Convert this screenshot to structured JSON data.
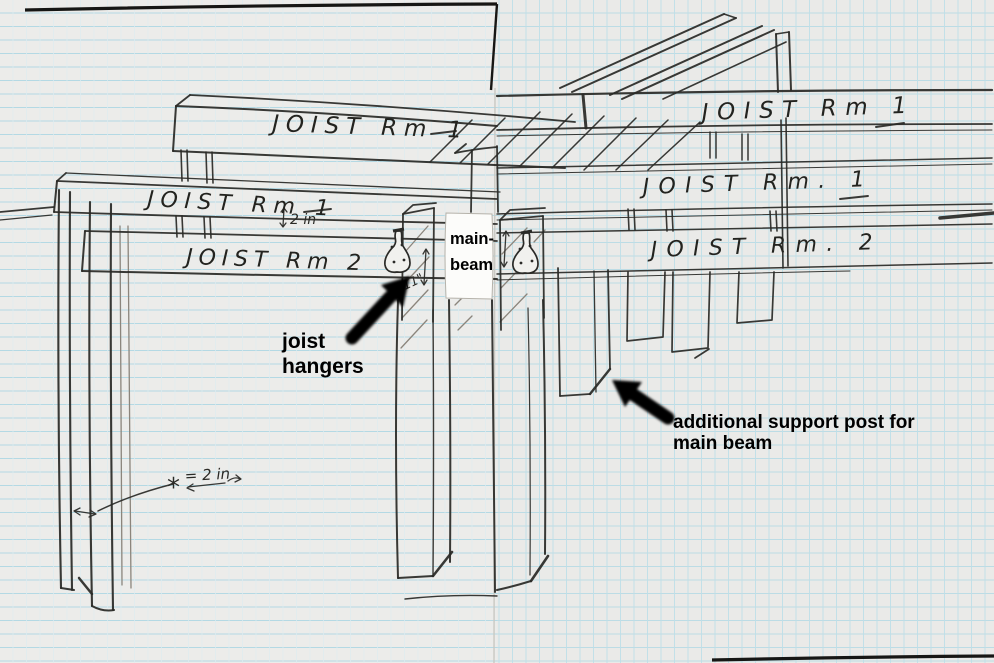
{
  "meta": {
    "description": "Hand-drawn construction sketch on graph paper showing floor joists for two rooms, a main beam, joist hangers, and support posts"
  },
  "beam_labels": {
    "room1_top_left": "JOIST Rm 1",
    "room1_top_right": "JOIST Rm 1",
    "room1_mid_left": "JOIST Rm 1",
    "room1_mid_right": "JOIST Rm. 1",
    "room2_left": "JOIST Rm 2",
    "room2_right": "JOIST Rm. 2"
  },
  "annotations": {
    "joist_hangers": {
      "line1": "joist",
      "line2": "hangers"
    },
    "support_post": {
      "line1": "additional support post for",
      "line2": "main beam"
    },
    "main_beam": {
      "line1": "main-",
      "line2": "beam"
    }
  },
  "measurements": {
    "gap_above_room2_beam": "2 in",
    "hanger_post_height": "11\"",
    "legend_symbol": "*",
    "legend_equals": "= 2 in"
  },
  "colors": {
    "paper_left": "#ececea",
    "paper_right": "#eaeae8",
    "grid_blue": "#b7dbe5",
    "ink": "#29292657",
    "ink_solid": "#2a2a27",
    "pencil": "#8b857c",
    "annotation_black": "#000000",
    "label_box": "#fcfcfa"
  }
}
